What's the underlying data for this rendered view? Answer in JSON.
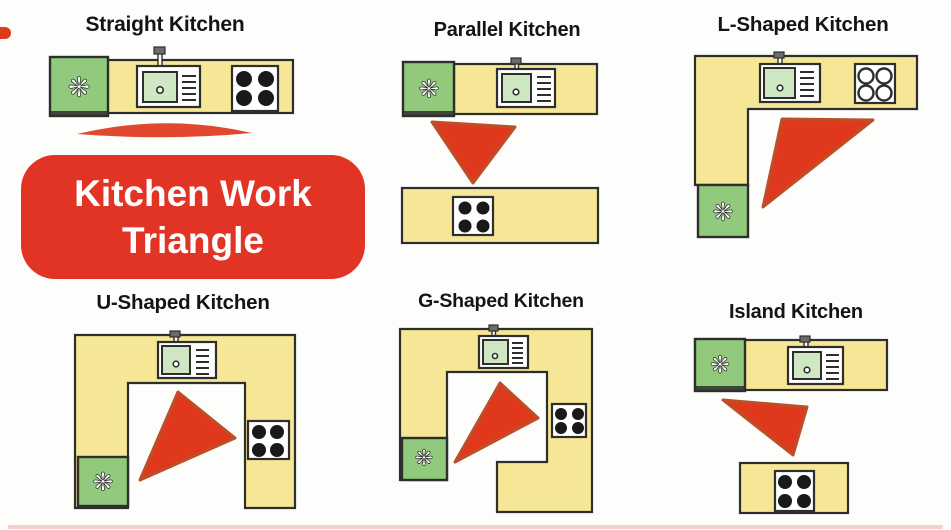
{
  "badge": {
    "label": "Kitchen Work Triangle"
  },
  "panels": [
    {
      "id": "straight",
      "title": "Straight Kitchen"
    },
    {
      "id": "parallel",
      "title": "Parallel Kitchen"
    },
    {
      "id": "l_shaped",
      "title": "L-Shaped Kitchen"
    },
    {
      "id": "u_shaped",
      "title": "U-Shaped Kitchen"
    },
    {
      "id": "g_shaped",
      "title": "G-Shaped Kitchen"
    },
    {
      "id": "island",
      "title": "Island Kitchen"
    }
  ],
  "icons": {
    "fridge": {
      "name": "fridge-fan-icon",
      "glyph": "❋"
    }
  },
  "colors": {
    "canvas_bg": "#fdfdfb",
    "counter_yellow": "#f5e795",
    "outline": "#2e2e2c",
    "fridge_green": "#92ca7d",
    "sink_green": "#cfe7c3",
    "appliance_white": "#ffffff",
    "burner_black": "#191919",
    "triangle_red": "#e0381c",
    "triangle_edge": "#bc4f28",
    "badge_red": "#e23425",
    "badge_text": "#ffffff",
    "title_text": "#141414",
    "bottom_strip": "#f3c4bd"
  }
}
